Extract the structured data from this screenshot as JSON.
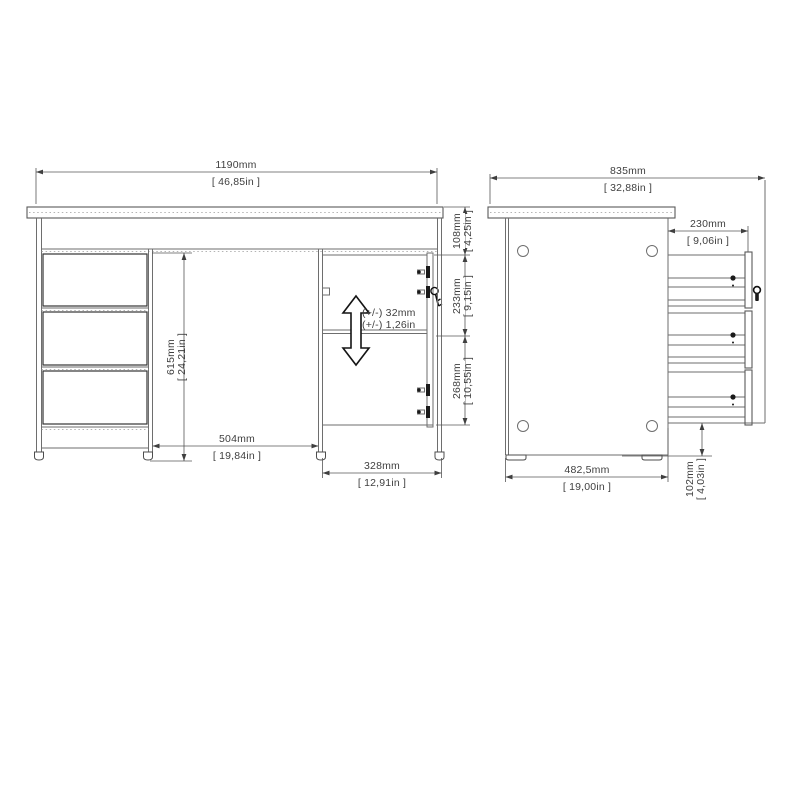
{
  "front_view": {
    "overall_width_mm": "1190mm",
    "overall_width_in": "[ 46,85in ]",
    "underdesk_height_mm": "615mm",
    "underdesk_height_in": "[ 24,21in ]",
    "knee_space_mm": "504mm",
    "knee_space_in": "[ 19,84in ]",
    "cabinet_width_mm": "328mm",
    "cabinet_width_in": "[ 12,91in ]",
    "apron_height_mm": "108mm",
    "apron_height_in": "[ 4,25in ]",
    "door_upper_mm": "233mm",
    "door_upper_in": "[ 9,15in ]",
    "door_lower_mm": "268mm",
    "door_lower_in": "[ 10,55in ]",
    "shelf_adjust_mm": "(+/-) 32mm",
    "shelf_adjust_in": "(+/-) 1,26in"
  },
  "side_view": {
    "overall_depth_mm": "835mm",
    "overall_depth_in": "[ 32,88in ]",
    "drawer_extension_mm": "230mm",
    "drawer_extension_in": "[ 9,06in ]",
    "base_depth_mm": "482,5mm",
    "base_depth_in": "[ 19,00in ]",
    "floor_clearance_mm": "102mm",
    "floor_clearance_in": "[ 4,03in ]"
  },
  "colors": {
    "background": "#ffffff",
    "line": "#6e6e6e",
    "dark_line": "#343434",
    "dimension_text": "#3f3f3f"
  }
}
